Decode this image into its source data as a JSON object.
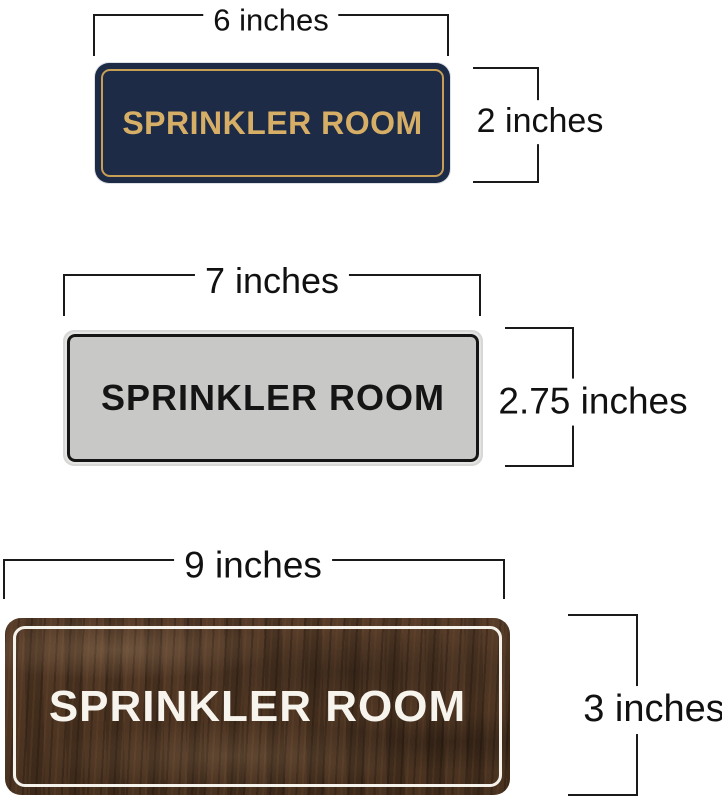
{
  "image": {
    "background": "#ffffff",
    "dimension_line_color": "#1a1a1a",
    "dimension_label_color": "#111111"
  },
  "sections": [
    {
      "sign_style": "navy-gold",
      "sign_text": "SPRINKLER ROOM",
      "width_label": "6 inches",
      "height_label": "2 inches",
      "colors": {
        "sign_background": "#1d2b47",
        "sign_border": "#c69e55",
        "sign_text": "#d6ae66"
      }
    },
    {
      "sign_style": "silver-black",
      "sign_text": "SPRINKLER ROOM",
      "width_label": "7 inches",
      "height_label": "2.75 inches",
      "colors": {
        "sign_background": "#c8c8c6",
        "sign_rim": "#d7d7d5",
        "sign_border": "#151515",
        "sign_text": "#151515"
      }
    },
    {
      "sign_style": "walnut-white",
      "sign_text": "SPRINKLER ROOM",
      "width_label": "9 inches",
      "height_label": "3 inches",
      "colors": {
        "sign_background": "#4a3424",
        "sign_border": "#f5f2ec",
        "sign_text": "#f7f4ee"
      }
    }
  ]
}
